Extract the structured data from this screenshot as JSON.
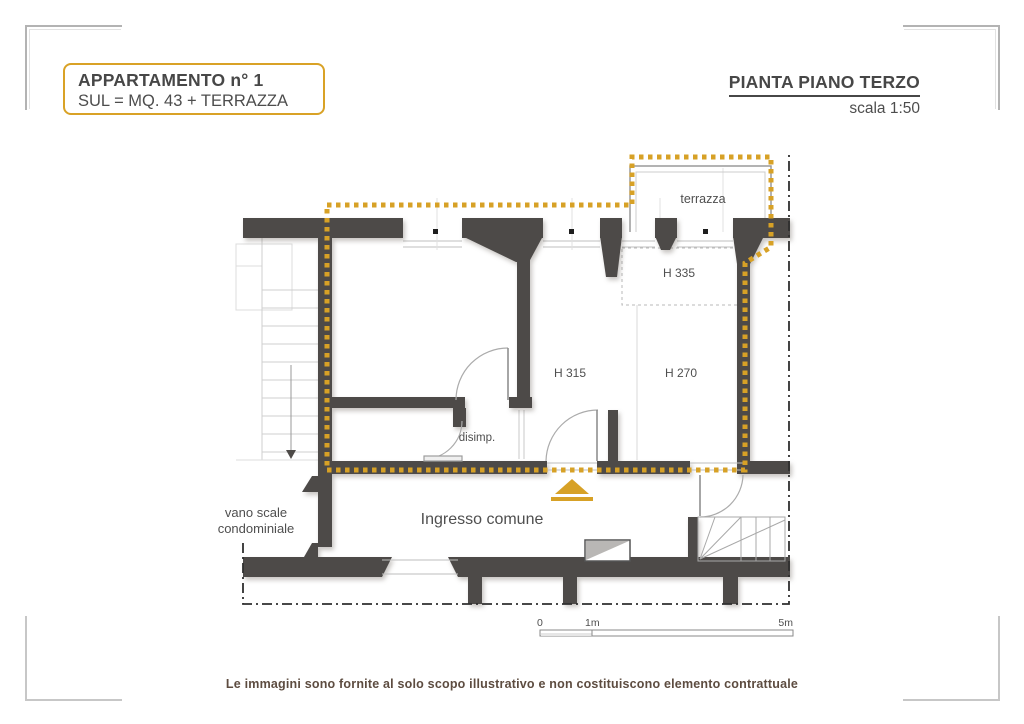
{
  "header": {
    "apartment_title": "APPARTAMENTO n° 1",
    "apartment_subtitle": "SUL = MQ. 43 + TERRAZZA",
    "plan_title": "PIANTA PIANO TERZO",
    "plan_scale": "scala 1:50"
  },
  "plan": {
    "labels": {
      "terrazza": "terrazza",
      "h335": "H 335",
      "h315": "H 315",
      "h270": "H 270",
      "disimp": "disimp.",
      "ingresso": "Ingresso comune",
      "vano_scale_line1": "vano scale",
      "vano_scale_line2": "condominiale"
    },
    "scale_bar": {
      "zero": "0",
      "one": "1m",
      "five": "5m"
    }
  },
  "footer": {
    "disclaimer": "Le immagini sono fornite al solo scopo illustrativo e non costituiscono elemento contrattuale"
  },
  "colors": {
    "wall": "#4d4a48",
    "gold": "#d7a126",
    "boundary": "#2f2f2f",
    "thin_line": "#c4c4c4",
    "title_text": "#474747",
    "footer_text": "#5d4c40"
  }
}
